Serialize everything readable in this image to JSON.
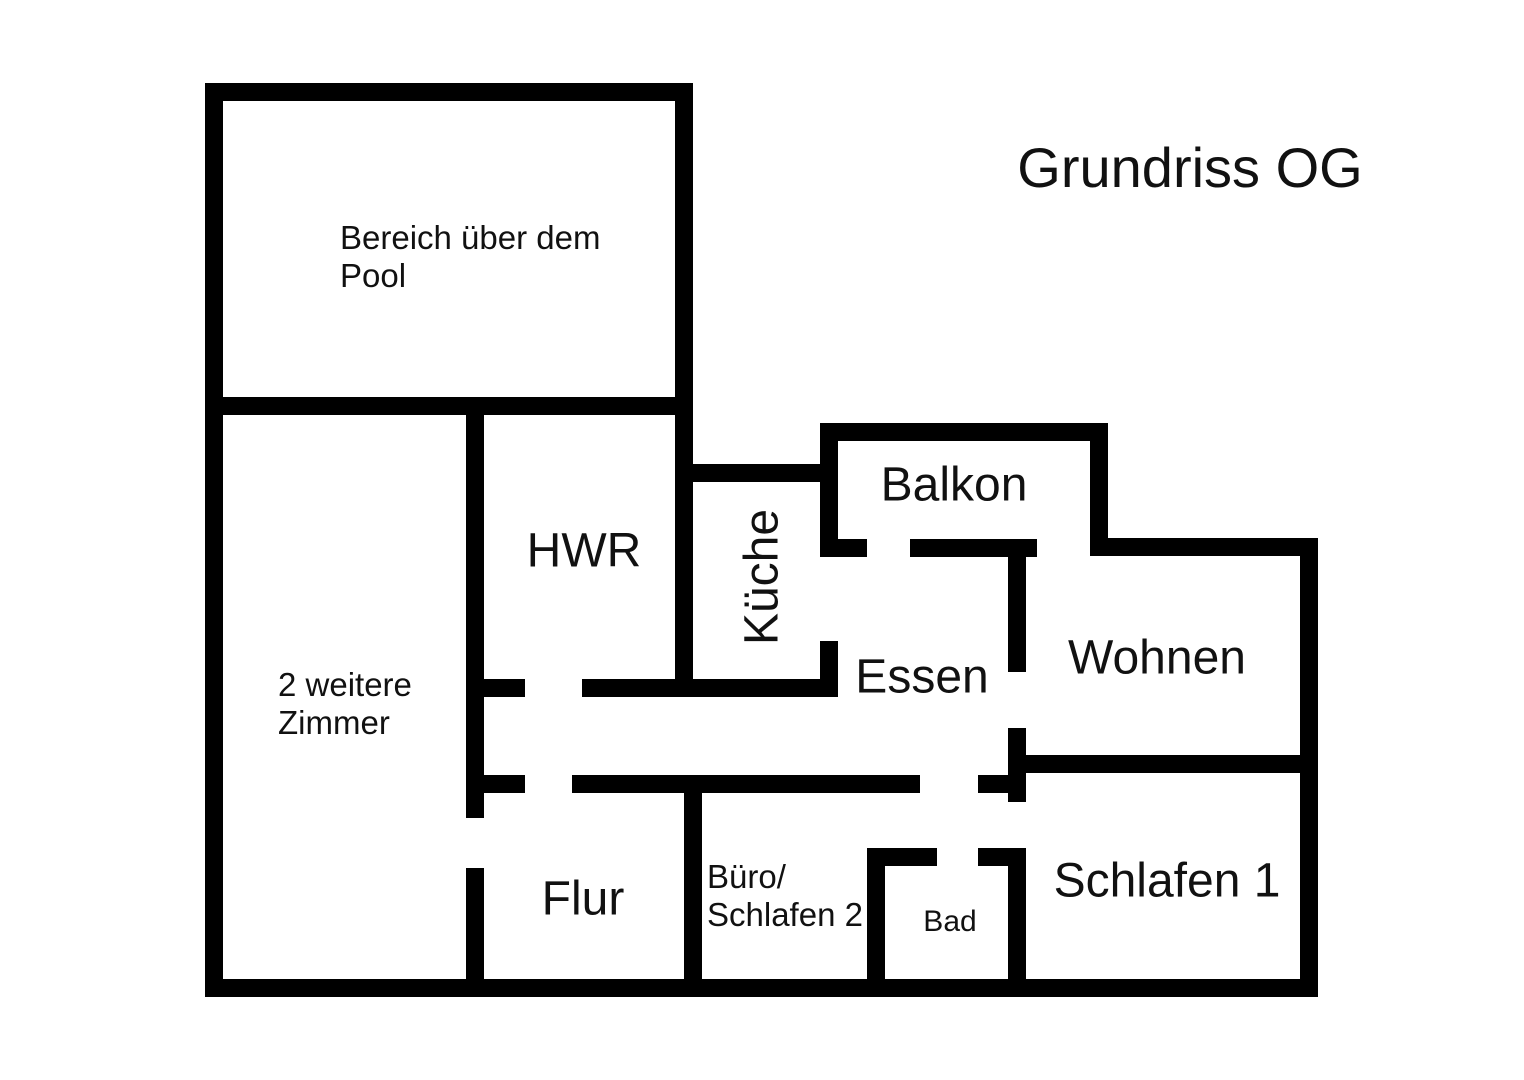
{
  "title": {
    "text": "Grundriss OG"
  },
  "floorplan": {
    "background": "#ffffff",
    "wall_color": "#000000",
    "text_color": "#111111",
    "walls": [
      {
        "x": 205,
        "y": 83,
        "w": 488,
        "h": 18,
        "name": "pool-box-top-wall"
      },
      {
        "x": 205,
        "y": 83,
        "w": 18,
        "h": 914,
        "name": "outer-left-wall"
      },
      {
        "x": 675,
        "y": 83,
        "w": 18,
        "h": 614,
        "name": "pool-hwr-right-wall"
      },
      {
        "x": 205,
        "y": 397,
        "w": 488,
        "h": 18,
        "name": "pool-box-bottom-wall"
      },
      {
        "x": 466,
        "y": 397,
        "w": 18,
        "h": 421,
        "name": "zimmer-divider-upper"
      },
      {
        "x": 466,
        "y": 868,
        "w": 18,
        "h": 129,
        "name": "zimmer-divider-lower"
      },
      {
        "x": 205,
        "y": 979,
        "w": 1113,
        "h": 18,
        "name": "outer-bottom-wall"
      },
      {
        "x": 1300,
        "y": 538,
        "w": 18,
        "h": 459,
        "name": "outer-right-wall"
      },
      {
        "x": 1090,
        "y": 538,
        "w": 228,
        "h": 18,
        "name": "wohnen-top-outer-wall"
      },
      {
        "x": 820,
        "y": 423,
        "w": 288,
        "h": 18,
        "name": "balkon-top-wall"
      },
      {
        "x": 820,
        "y": 423,
        "w": 18,
        "h": 134,
        "name": "balkon-left-wall"
      },
      {
        "x": 1090,
        "y": 423,
        "w": 18,
        "h": 133,
        "name": "balkon-right-wall"
      },
      {
        "x": 820,
        "y": 539,
        "w": 47,
        "h": 18,
        "name": "balkon-bottom-stub-left"
      },
      {
        "x": 910,
        "y": 539,
        "w": 127,
        "h": 18,
        "name": "balkon-bottom-segment"
      },
      {
        "x": 675,
        "y": 464,
        "w": 163,
        "h": 18,
        "name": "kueche-top-wall"
      },
      {
        "x": 820,
        "y": 641,
        "w": 18,
        "h": 56,
        "name": "kueche-right-lower-stub"
      },
      {
        "x": 582,
        "y": 679,
        "w": 256,
        "h": 18,
        "name": "hwr-kueche-bottom-wall"
      },
      {
        "x": 466,
        "y": 679,
        "w": 59,
        "h": 18,
        "name": "corridor-upper-stub"
      },
      {
        "x": 466,
        "y": 775,
        "w": 59,
        "h": 18,
        "name": "corridor-lower-stub"
      },
      {
        "x": 572,
        "y": 775,
        "w": 348,
        "h": 18,
        "name": "corridor-lower-wall"
      },
      {
        "x": 978,
        "y": 775,
        "w": 48,
        "h": 18,
        "name": "corridor-lower-right-stub"
      },
      {
        "x": 1008,
        "y": 556,
        "w": 18,
        "h": 116,
        "name": "essen-wohnen-divider-upper"
      },
      {
        "x": 1008,
        "y": 728,
        "w": 18,
        "h": 74,
        "name": "essen-wohnen-divider-mid"
      },
      {
        "x": 1026,
        "y": 755,
        "w": 292,
        "h": 18,
        "name": "wohnen-bottom-wall"
      },
      {
        "x": 684,
        "y": 775,
        "w": 18,
        "h": 222,
        "name": "flur-buero-divider"
      },
      {
        "x": 867,
        "y": 848,
        "w": 18,
        "h": 149,
        "name": "bad-left-wall"
      },
      {
        "x": 867,
        "y": 848,
        "w": 70,
        "h": 18,
        "name": "bad-top-left-stub"
      },
      {
        "x": 978,
        "y": 848,
        "w": 48,
        "h": 18,
        "name": "bad-top-right-stub"
      },
      {
        "x": 1008,
        "y": 848,
        "w": 18,
        "h": 149,
        "name": "bad-right-wall"
      }
    ],
    "labels": [
      {
        "id": "title",
        "text": "Grundriss OG",
        "x": 1190,
        "y": 168,
        "font_size": 56,
        "anchor": "center"
      },
      {
        "id": "bereich",
        "text": "Bereich über dem\nPool",
        "x": 340,
        "y": 219,
        "font_size": 33,
        "anchor": "top-left"
      },
      {
        "id": "zimmer",
        "text": "2 weitere\nZimmer",
        "x": 278,
        "y": 666,
        "font_size": 33,
        "anchor": "top-left"
      },
      {
        "id": "hwr",
        "text": "HWR",
        "x": 584,
        "y": 552,
        "font_size": 48,
        "anchor": "center"
      },
      {
        "id": "kueche",
        "text": "Küche",
        "x": 763,
        "y": 577,
        "font_size": 48,
        "anchor": "center",
        "rotate": -90
      },
      {
        "id": "balkon",
        "text": "Balkon",
        "x": 954,
        "y": 486,
        "font_size": 48,
        "anchor": "center"
      },
      {
        "id": "essen",
        "text": "Essen",
        "x": 922,
        "y": 678,
        "font_size": 48,
        "anchor": "center"
      },
      {
        "id": "wohnen",
        "text": "Wohnen",
        "x": 1157,
        "y": 659,
        "font_size": 48,
        "anchor": "center"
      },
      {
        "id": "flur",
        "text": "Flur",
        "x": 583,
        "y": 900,
        "font_size": 48,
        "anchor": "center"
      },
      {
        "id": "buero",
        "text": "Büro/\nSchlafen 2",
        "x": 707,
        "y": 858,
        "font_size": 33,
        "anchor": "top-left"
      },
      {
        "id": "bad",
        "text": "Bad",
        "x": 950,
        "y": 922,
        "font_size": 30,
        "anchor": "center"
      },
      {
        "id": "schlafen1",
        "text": "Schlafen 1",
        "x": 1167,
        "y": 882,
        "font_size": 48,
        "anchor": "center"
      }
    ]
  }
}
